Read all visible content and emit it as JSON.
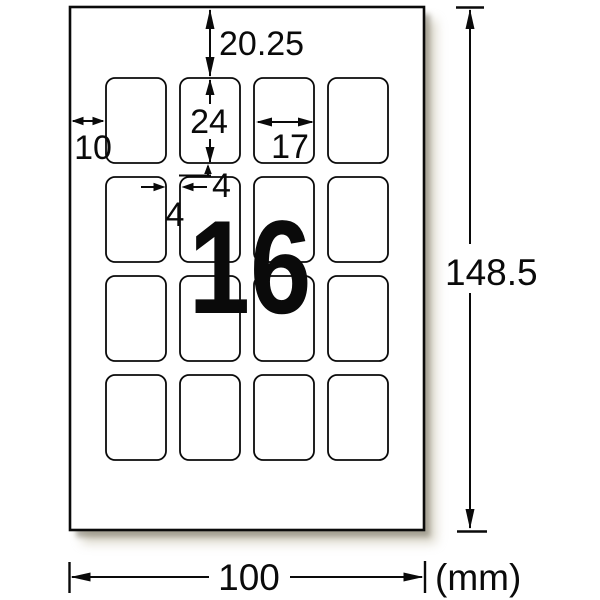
{
  "diagram": {
    "title": "label-sheet-dimension-diagram",
    "product_label_count": "16",
    "unit": "(mm)",
    "grid": {
      "rows": 4,
      "cols": 4
    },
    "dimensions": {
      "top_margin": "20.25",
      "label_height": "24",
      "label_width": "17",
      "left_margin": "10",
      "gap_horizontal": "4",
      "gap_vertical": "4",
      "sheet_height": "148.5",
      "sheet_width": "100"
    },
    "colors": {
      "accent_pink": "#f3aacd",
      "line": "#0a0a0a",
      "paper": "#ffffff"
    }
  }
}
